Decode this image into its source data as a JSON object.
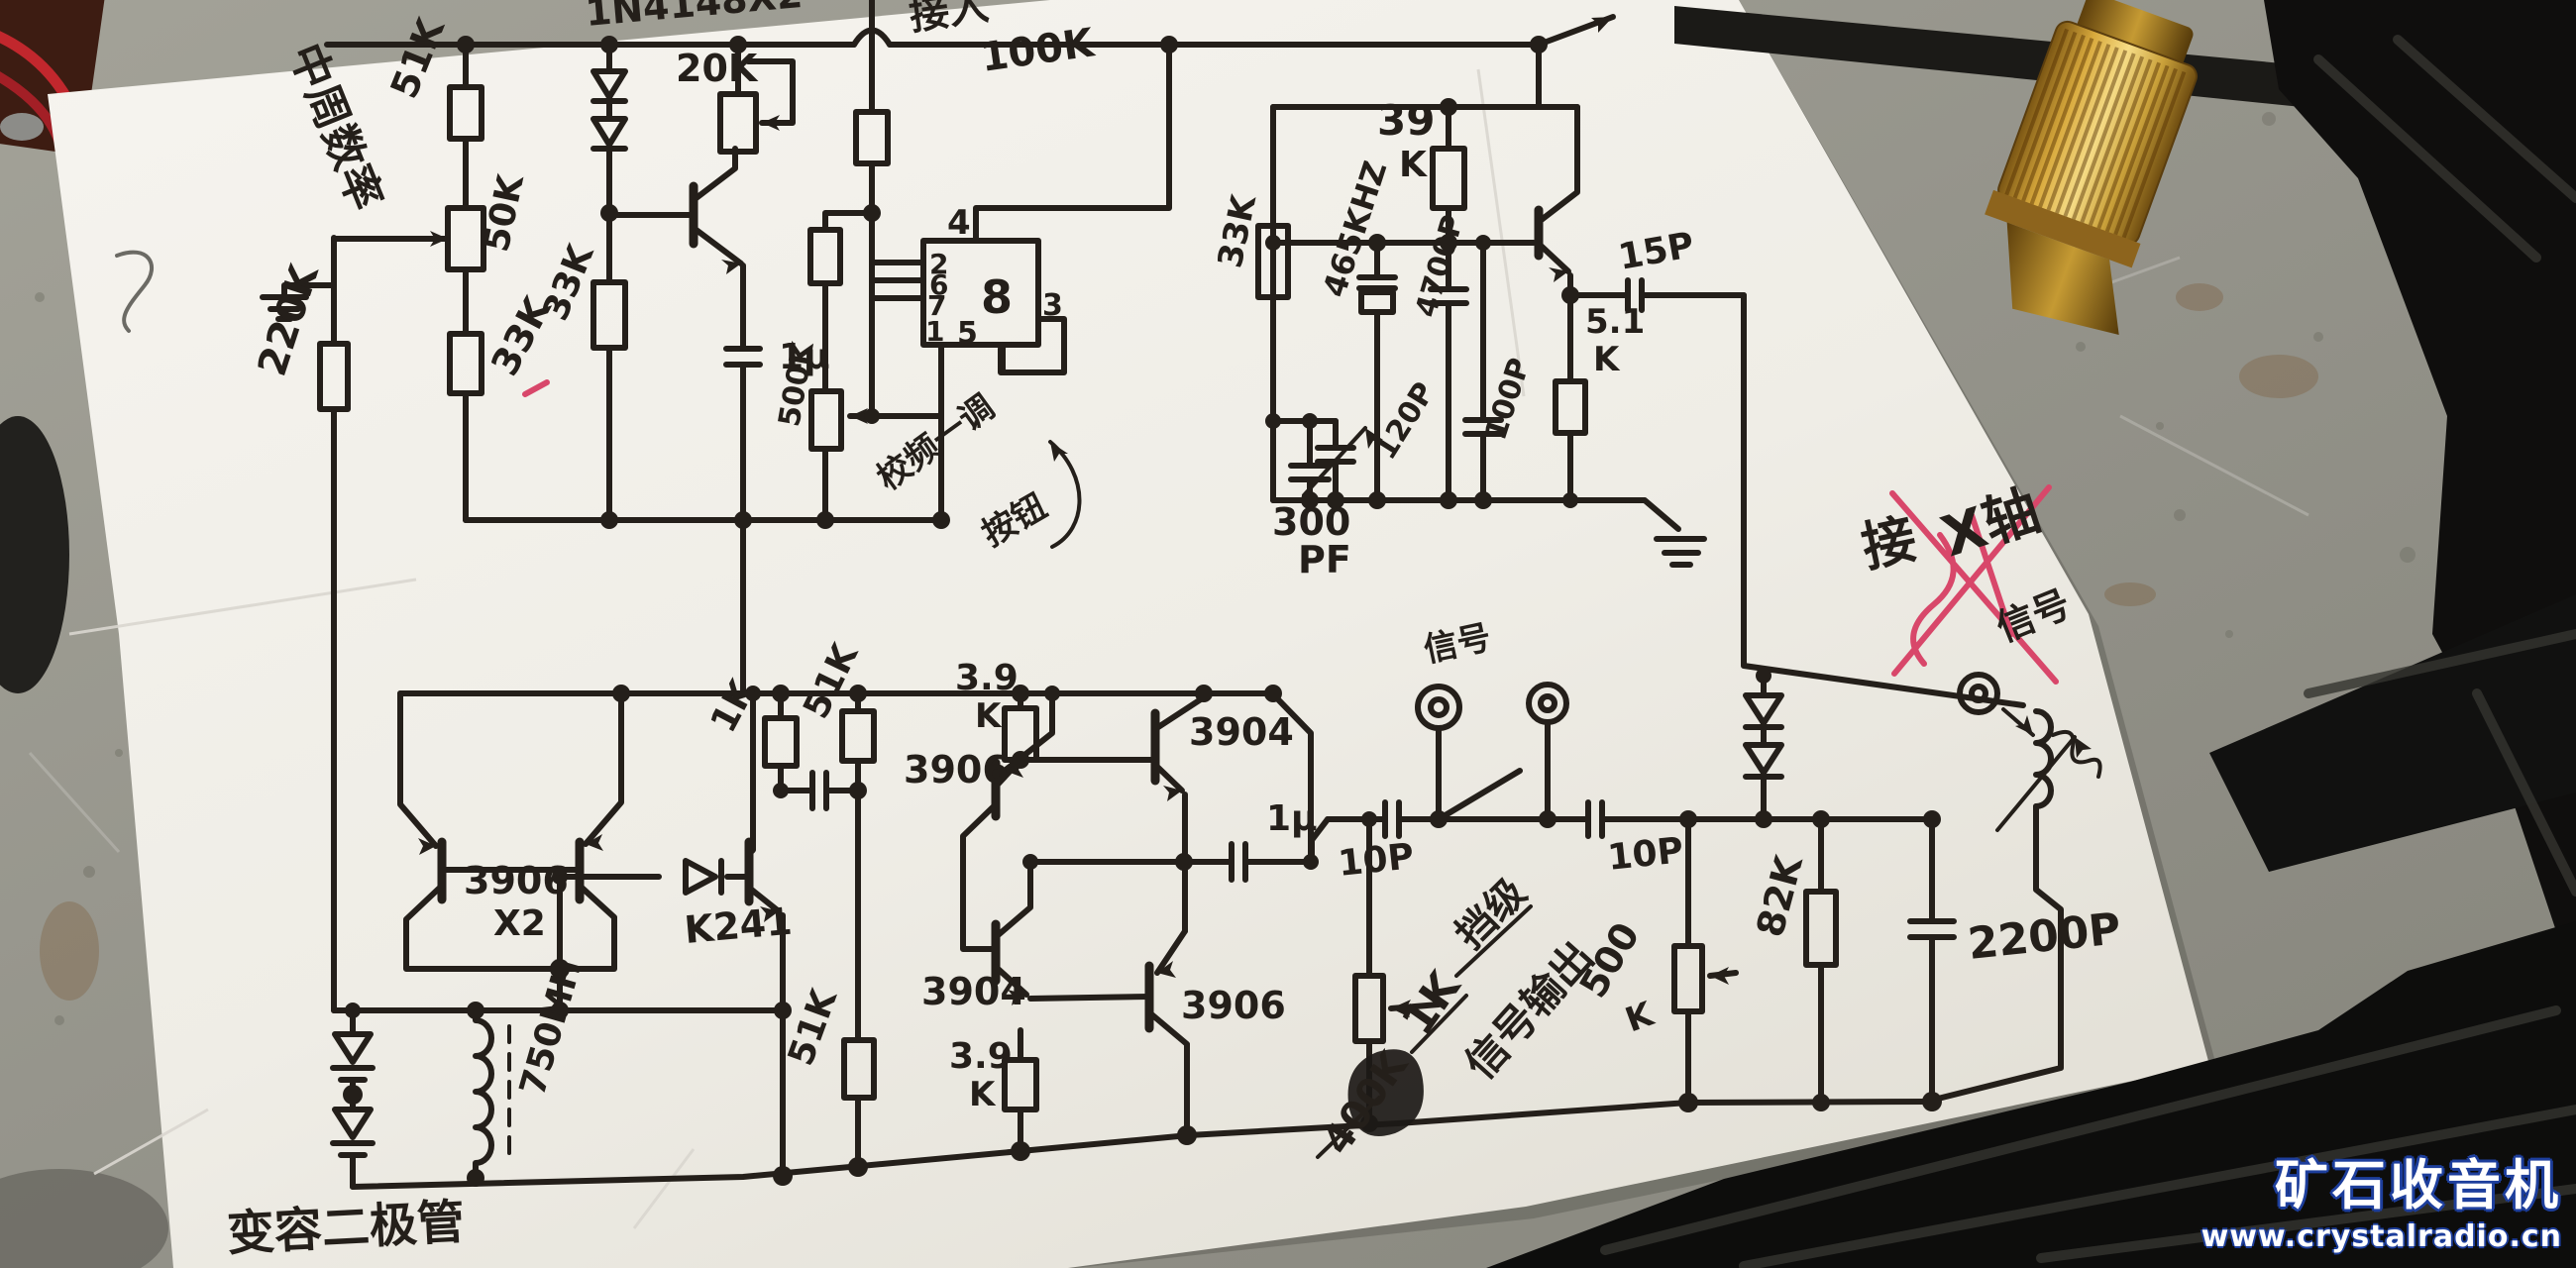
{
  "watermark": {
    "brand": "矿石收音机",
    "url": "www.crystalradio.cn"
  },
  "colors": {
    "paper": "#f3f1ea",
    "ink": "#241f1a",
    "concrete": "#98978d",
    "cable": "#0f0e0d",
    "brass": "#d8a93c",
    "red_mark": "#d8476a",
    "watermark_blue": "#1d3e9c"
  },
  "schematic": {
    "labels": {
      "note_mid_freq": "中周数率",
      "note_top_in": "接入",
      "d_top": "1N4148X2",
      "r20k": "20K",
      "r100k_top": "100K",
      "r51k_top": "51K",
      "pot50k": "50K",
      "r220k": "220K",
      "r33k_a": "33K",
      "r33k_b": "33K",
      "c1u_a": "1μ",
      "pot500k_a": "500K",
      "note_tune": "校频一调",
      "note_btn": "按钮",
      "ic": {
        "p4": "4",
        "p2": "2",
        "p6": "6",
        "p7": "7",
        "p1": "1",
        "p8": "8",
        "p5": "5",
        "p3": "3"
      },
      "r39k_v": "39",
      "r39k_u": "K",
      "f465": "465KHZ",
      "c4700p": "4700P",
      "c15p": "15P",
      "r5k1_v": "5.1",
      "r5k1_u": "K",
      "r33k_c": "33K",
      "c120p": "120P",
      "c100p": "100P",
      "c300pf_v": "300",
      "c300pf_u": "PF",
      "note_jie": "接",
      "note_xzhou": "X轴",
      "note_xinhao": "信号",
      "note_jack": "信号",
      "q_pair": "3906",
      "q_pair_x2": "X2",
      "q_k241": "K241",
      "l750": "750MH",
      "note_varactor": "变容二极管",
      "r1k": "1K",
      "r51k_a": "51K",
      "r3k9a_v": "3.9",
      "r3k9a_u": "K",
      "q3906_a": "3906",
      "q3904_a": "3904",
      "q3904_b": "3904",
      "q3906_b": "3906",
      "r3k9b_v": "3.9",
      "r3k9b_u": "K",
      "r51k_b": "51K",
      "c1u_b": "1μ",
      "c10p_a": "10P",
      "c10p_b": "10P",
      "note_dang": "挡级",
      "note_1k": "1K",
      "note_400k": "400K",
      "note_sigout": "信号输出",
      "pot500k_b_v": "500",
      "pot500k_b_u": "K",
      "r82k": "82K",
      "c2200p": "2200P"
    }
  }
}
